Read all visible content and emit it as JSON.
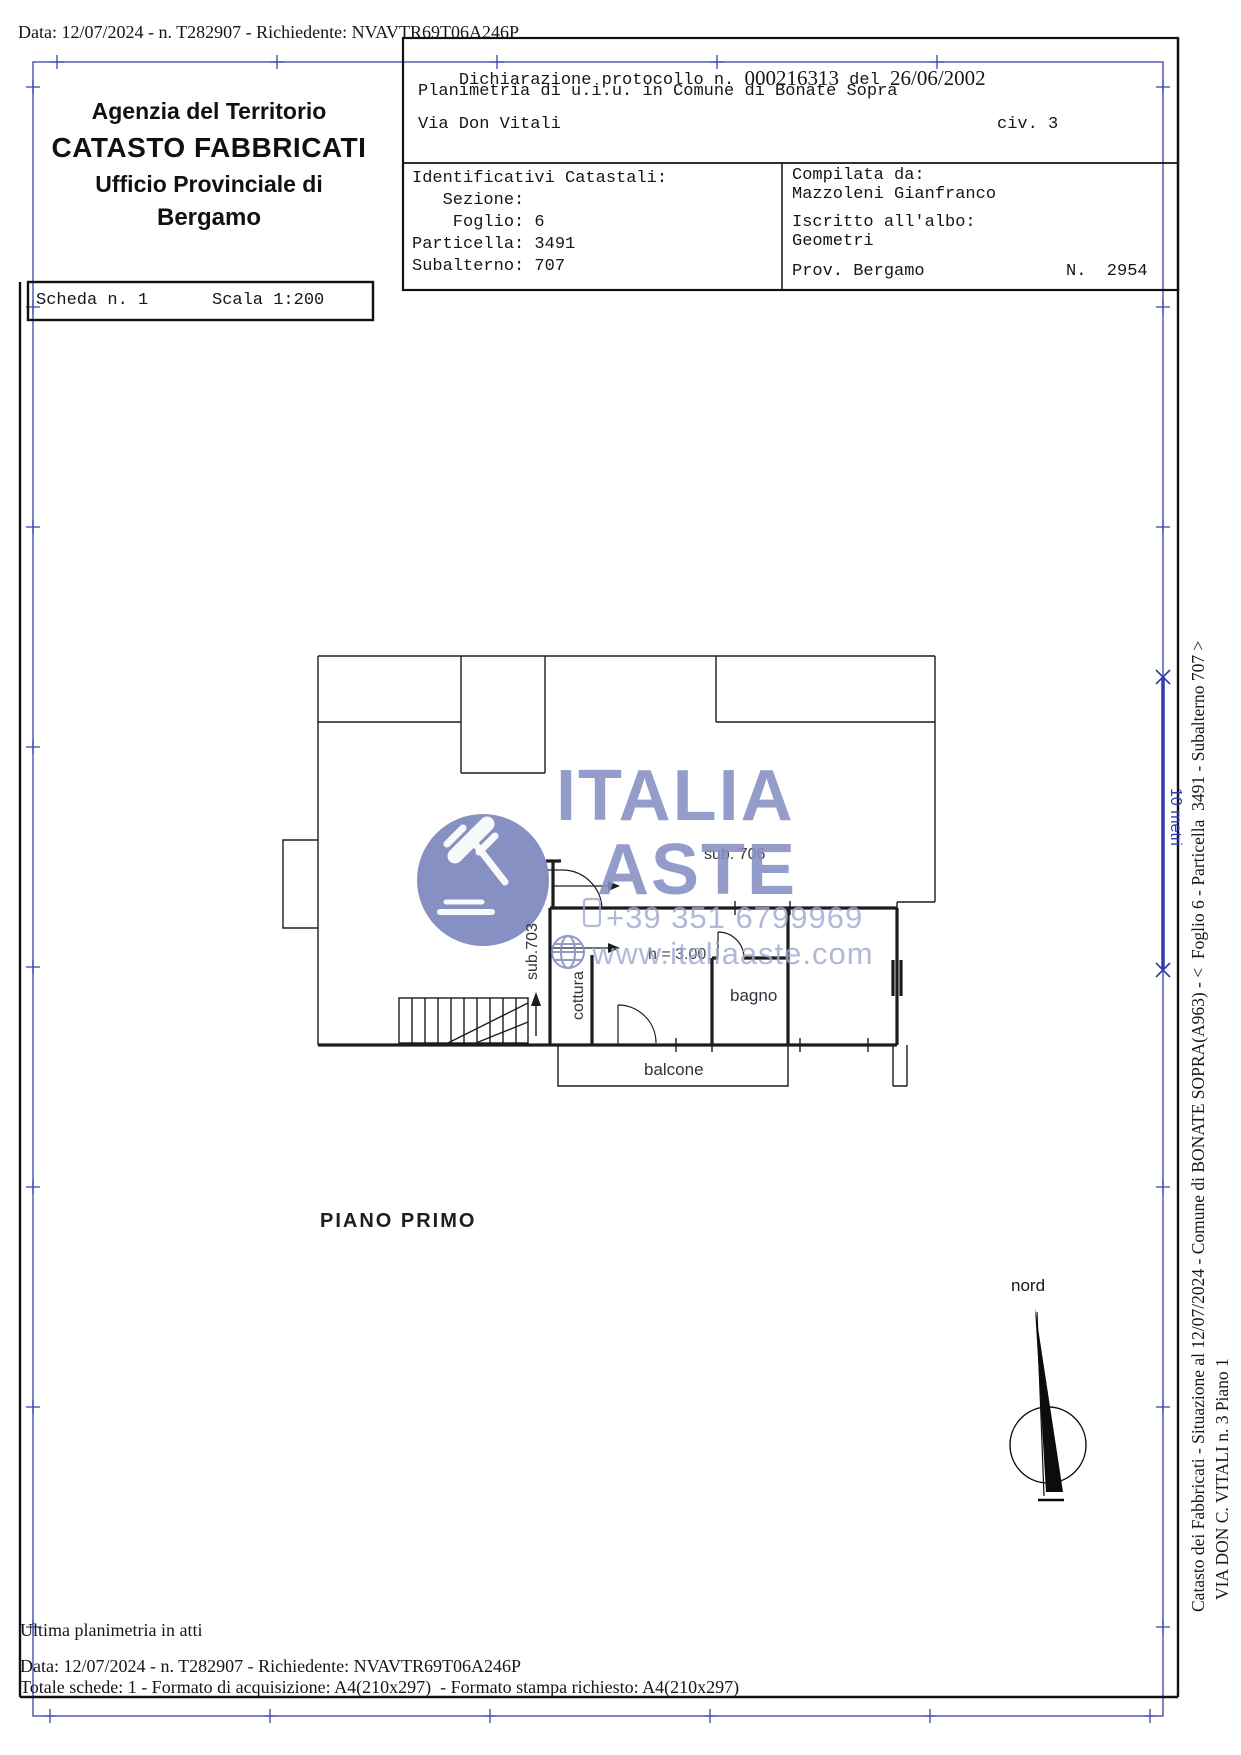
{
  "meta_top": "Data: 12/07/2024 - n. T282907 - Richiedente: NVAVTR69T06A246P",
  "agency": {
    "line1": "Agenzia del Territorio",
    "line2": "CATASTO FABBRICATI",
    "line3": "Ufficio Provinciale di",
    "line4": "Bergamo"
  },
  "scheda": {
    "label": "Scheda n. 1",
    "scala": "Scala 1:200"
  },
  "declaration": {
    "part1": "Dichiarazione protocollo n. ",
    "number": "000216313",
    "del": " del ",
    "date": "26/06/2002",
    "line2": "Planimetria di u.i.u. in Comune di Bonate Sopra",
    "street": "Via Don Vitali",
    "civ": "civ. 3"
  },
  "identifiers": {
    "title": "Identificativi Catastali:",
    "sezione": "   Sezione:",
    "foglio": "    Foglio: 6",
    "particella": "Particella: 3491",
    "subalterno": "Subalterno: 707"
  },
  "compiler": {
    "label": "Compilata da:",
    "name": "Mazzoleni Gianfranco",
    "albo_label": "Iscritto all'albo:",
    "albo": "Geometri",
    "prov": "Prov. Bergamo",
    "number": "N.  2954"
  },
  "plan": {
    "labels": {
      "sub706": "sub. 706",
      "sub703": "sub.703",
      "cottura": "cottura",
      "bagno": "bagno",
      "balcone": "balcone",
      "height": "h = 3.00",
      "floor": "PIANO PRIMO",
      "north": "nord"
    }
  },
  "watermark": {
    "brand_line1": "ITALIA",
    "brand_line2": "ASTE",
    "phone": "+39 351 6799969",
    "website": "www.italiaaste.com"
  },
  "scalebar": {
    "label": "10 metri"
  },
  "margin_notes": {
    "line1": "Catasto dei Fabbricati - Situazione al 12/07/2024 - Comune di BONATE SOPRA(A963) - <  Foglio 6 - Particella  3491 - Subalterno 707 >",
    "line2": "VIA DON C. VITALI n. 3 Piano 1"
  },
  "footer": {
    "line1": "Ultima planimetria in atti",
    "line2": "Data: 12/07/2024 - n. T282907 - Richiedente: NVAVTR69T06A246P",
    "line3": "Totale schede: 1 - Formato di acquisizione: A4(210x297)  - Formato stampa richiesto: A4(210x297)"
  },
  "colors": {
    "margin_blue": "#3644a6",
    "scalebar_blue": "#2d3fb0",
    "watermark_slate": "#7d87bd",
    "watermark_text": "#868fc2",
    "watermark_small": "#9ea7cf",
    "ink": "#1a1a1a"
  }
}
